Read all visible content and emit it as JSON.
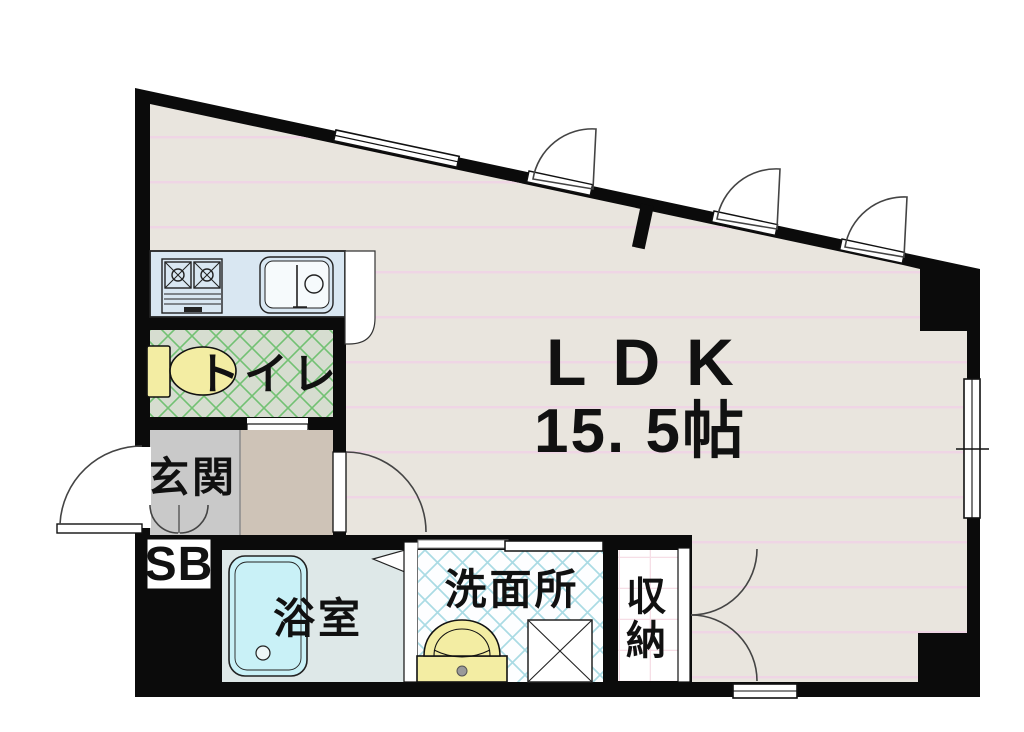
{
  "page": {
    "width": 1024,
    "height": 732,
    "background": "#ffffff"
  },
  "plan": {
    "rooms": {
      "ldk": {
        "name": "LDK",
        "area": "15. 5帖"
      },
      "toilet": {
        "name": "トイレ"
      },
      "entrance": {
        "name": "玄関"
      },
      "shoe_box": {
        "name": "SB"
      },
      "bathroom": {
        "name": "浴室"
      },
      "washroom": {
        "name": "洗面所"
      },
      "closet": {
        "name": "収納",
        "chars": [
          "収",
          "納"
        ]
      }
    },
    "colors": {
      "wall": "#0b0b0b",
      "ldk_floor": "#e9e5de",
      "ldk_stripe": "#efd5e5",
      "kitchen_counter": "#d9e7f2",
      "toilet_floor": "#d6ddd0",
      "toilet_hatch": "#72c173",
      "entrance_floor": "#c9c9c9",
      "hallway_floor": "#cec3b7",
      "bathroom_floor": "#dee8e8",
      "bathtub": "#c9f1f7",
      "washroom_hatch": "#aadbe4",
      "fixture_yellow": "#f3eda3",
      "closet_grid": "#f6dee6"
    }
  }
}
